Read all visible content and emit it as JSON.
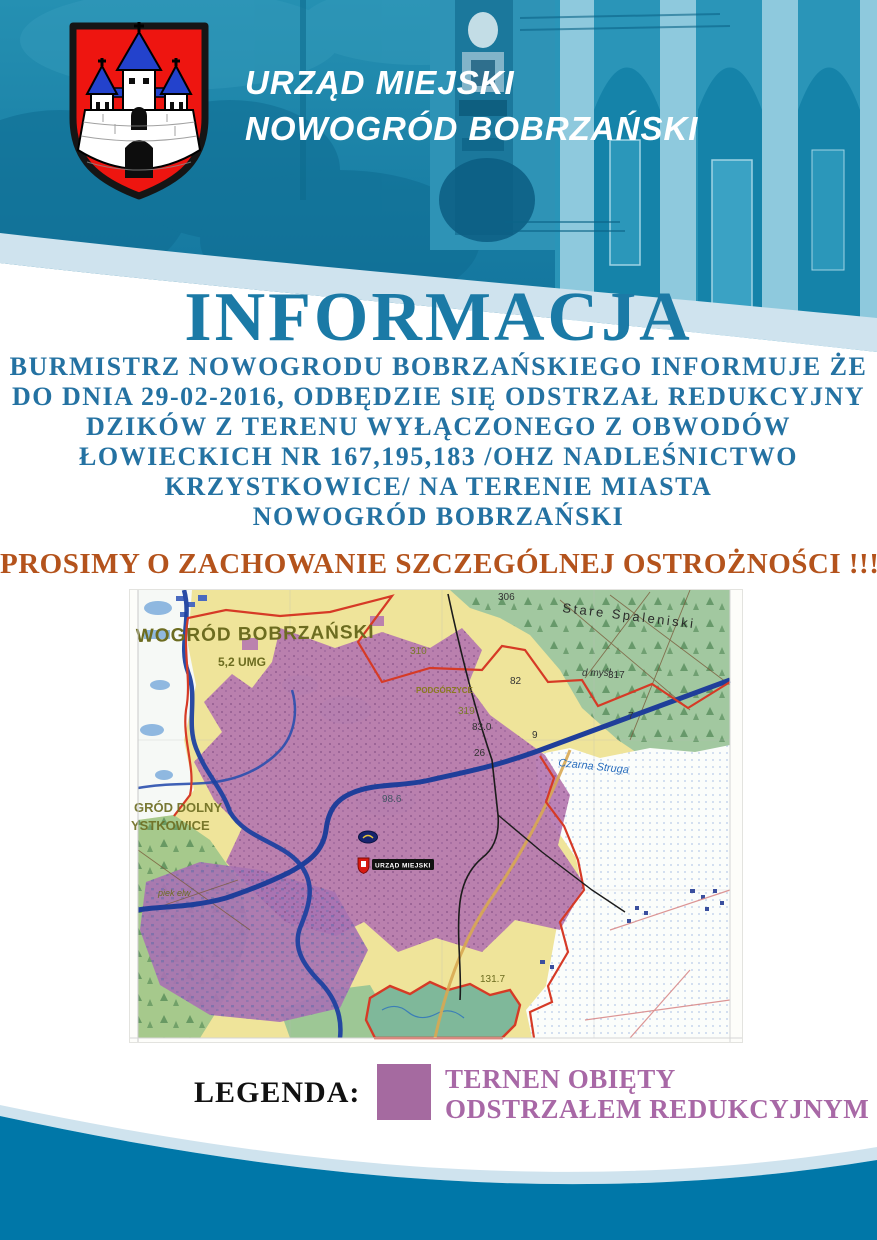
{
  "header": {
    "org_name_line1": "URZĄD MIEJSKI",
    "org_name_line2": "NOWOGRÓD BOBRZAŃSKI",
    "crest_alt": "nowogrod-bobrzanski-coat-of-arms"
  },
  "announcement": {
    "title": "INFORMACJA",
    "body_lines": [
      "BURMISTRZ NOWOGRODU BOBRZAŃSKIEGO INFORMUJE ŻE",
      "DO DNIA 29-02-2016,  ODBĘDZIE SIĘ ODSTRZAŁ REDUKCYJNY",
      "DZIKÓW Z TERENU WYŁĄCZONEGO Z  OBWODÓW",
      "ŁOWIECKICH NR 167,195,183 /OHZ NADLEŚNICTWO",
      "KRZYSTKOWICE/ NA TERENIE MIASTA",
      "NOWOGRÓD BOBRZAŃSKI"
    ],
    "warning": "PROSIMY O ZACHOWANIE SZCZEGÓLNEJ OSTROŻNOŚCI !!!"
  },
  "map": {
    "town_label": "WOGRÓD BOBRZAŃSKI",
    "town_sublabel": "5,2 UMG",
    "office_marker_label": "URZĄD MIEJSKI",
    "place_labels": {
      "stare_spaleniski": "Stare Spaleniski",
      "podgorzyce": "PODGÓRZYCE",
      "grod_dolny": "GRÓD DOLNY",
      "ystkowice": "YSTKOWICE",
      "czarna_struga": "Czarna Struga",
      "d_mysl": "d myśl",
      "piek_elw": "piek elw"
    },
    "spot_heights": {
      "a306": "306",
      "a310": "310",
      "a317": "317",
      "a82": "82",
      "a319": "319",
      "a830": "83.0",
      "a9": "9",
      "a7": "7",
      "a26": "26",
      "a986": "98.6",
      "a1317": "131.7"
    },
    "zone_color": "#b577b0"
  },
  "legend": {
    "label": "LEGENDA:",
    "item_line1": "TERNEN OBIĘTY",
    "item_line2": "ODSTRZAŁEM REDUKCYJNYM",
    "swatch_color": "#a56aa0",
    "text_color": "#a868a6"
  },
  "colors": {
    "title_text": "#1b7aa6",
    "body_text": "#2472a2",
    "warning_text": "#b4531c",
    "header_teal": "#1b84a8",
    "footer_teal": "#0077a8",
    "band_light_blue": "#cfe3ee"
  }
}
